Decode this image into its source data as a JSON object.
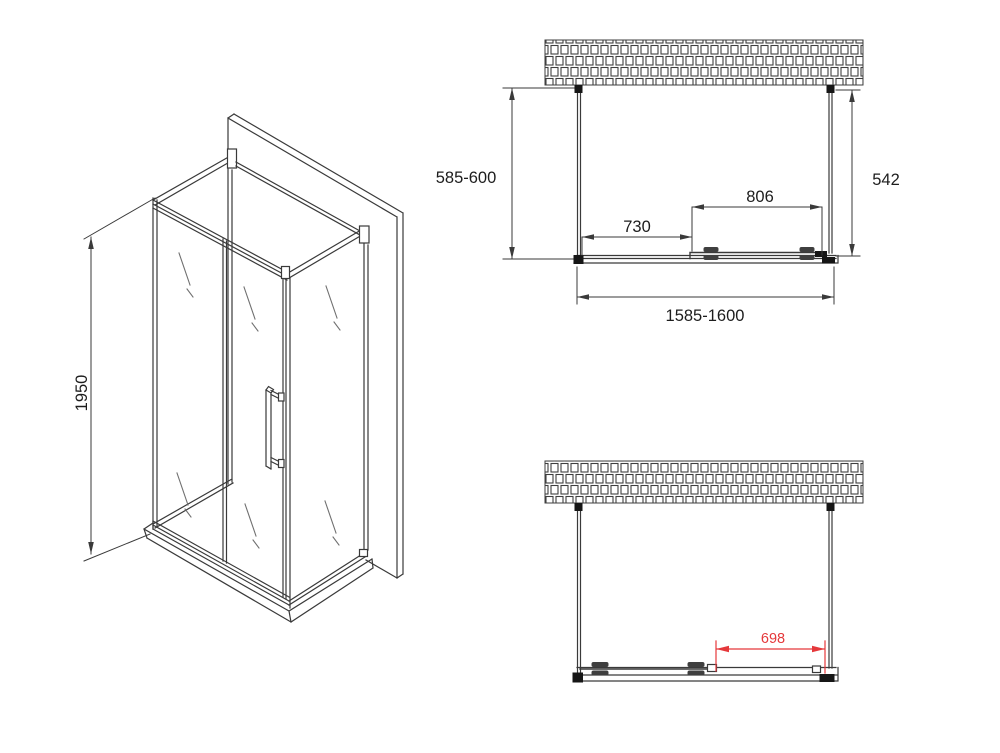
{
  "drawing": {
    "subject": "shower-enclosure-technical-drawing",
    "colors": {
      "line": "#3a3a3a",
      "accent_red": "#e5383b",
      "background": "#ffffff",
      "bracket_black": "#161616"
    },
    "isometric": {
      "height_dim": "1950"
    },
    "plan_closed": {
      "left_depth_dim": "585-600",
      "right_depth_dim": "542",
      "sliding_door_dim": "806",
      "fixed_panel_dim": "730",
      "total_width_dim": "1585-1600"
    },
    "plan_open": {
      "opening_dim": "698"
    }
  }
}
